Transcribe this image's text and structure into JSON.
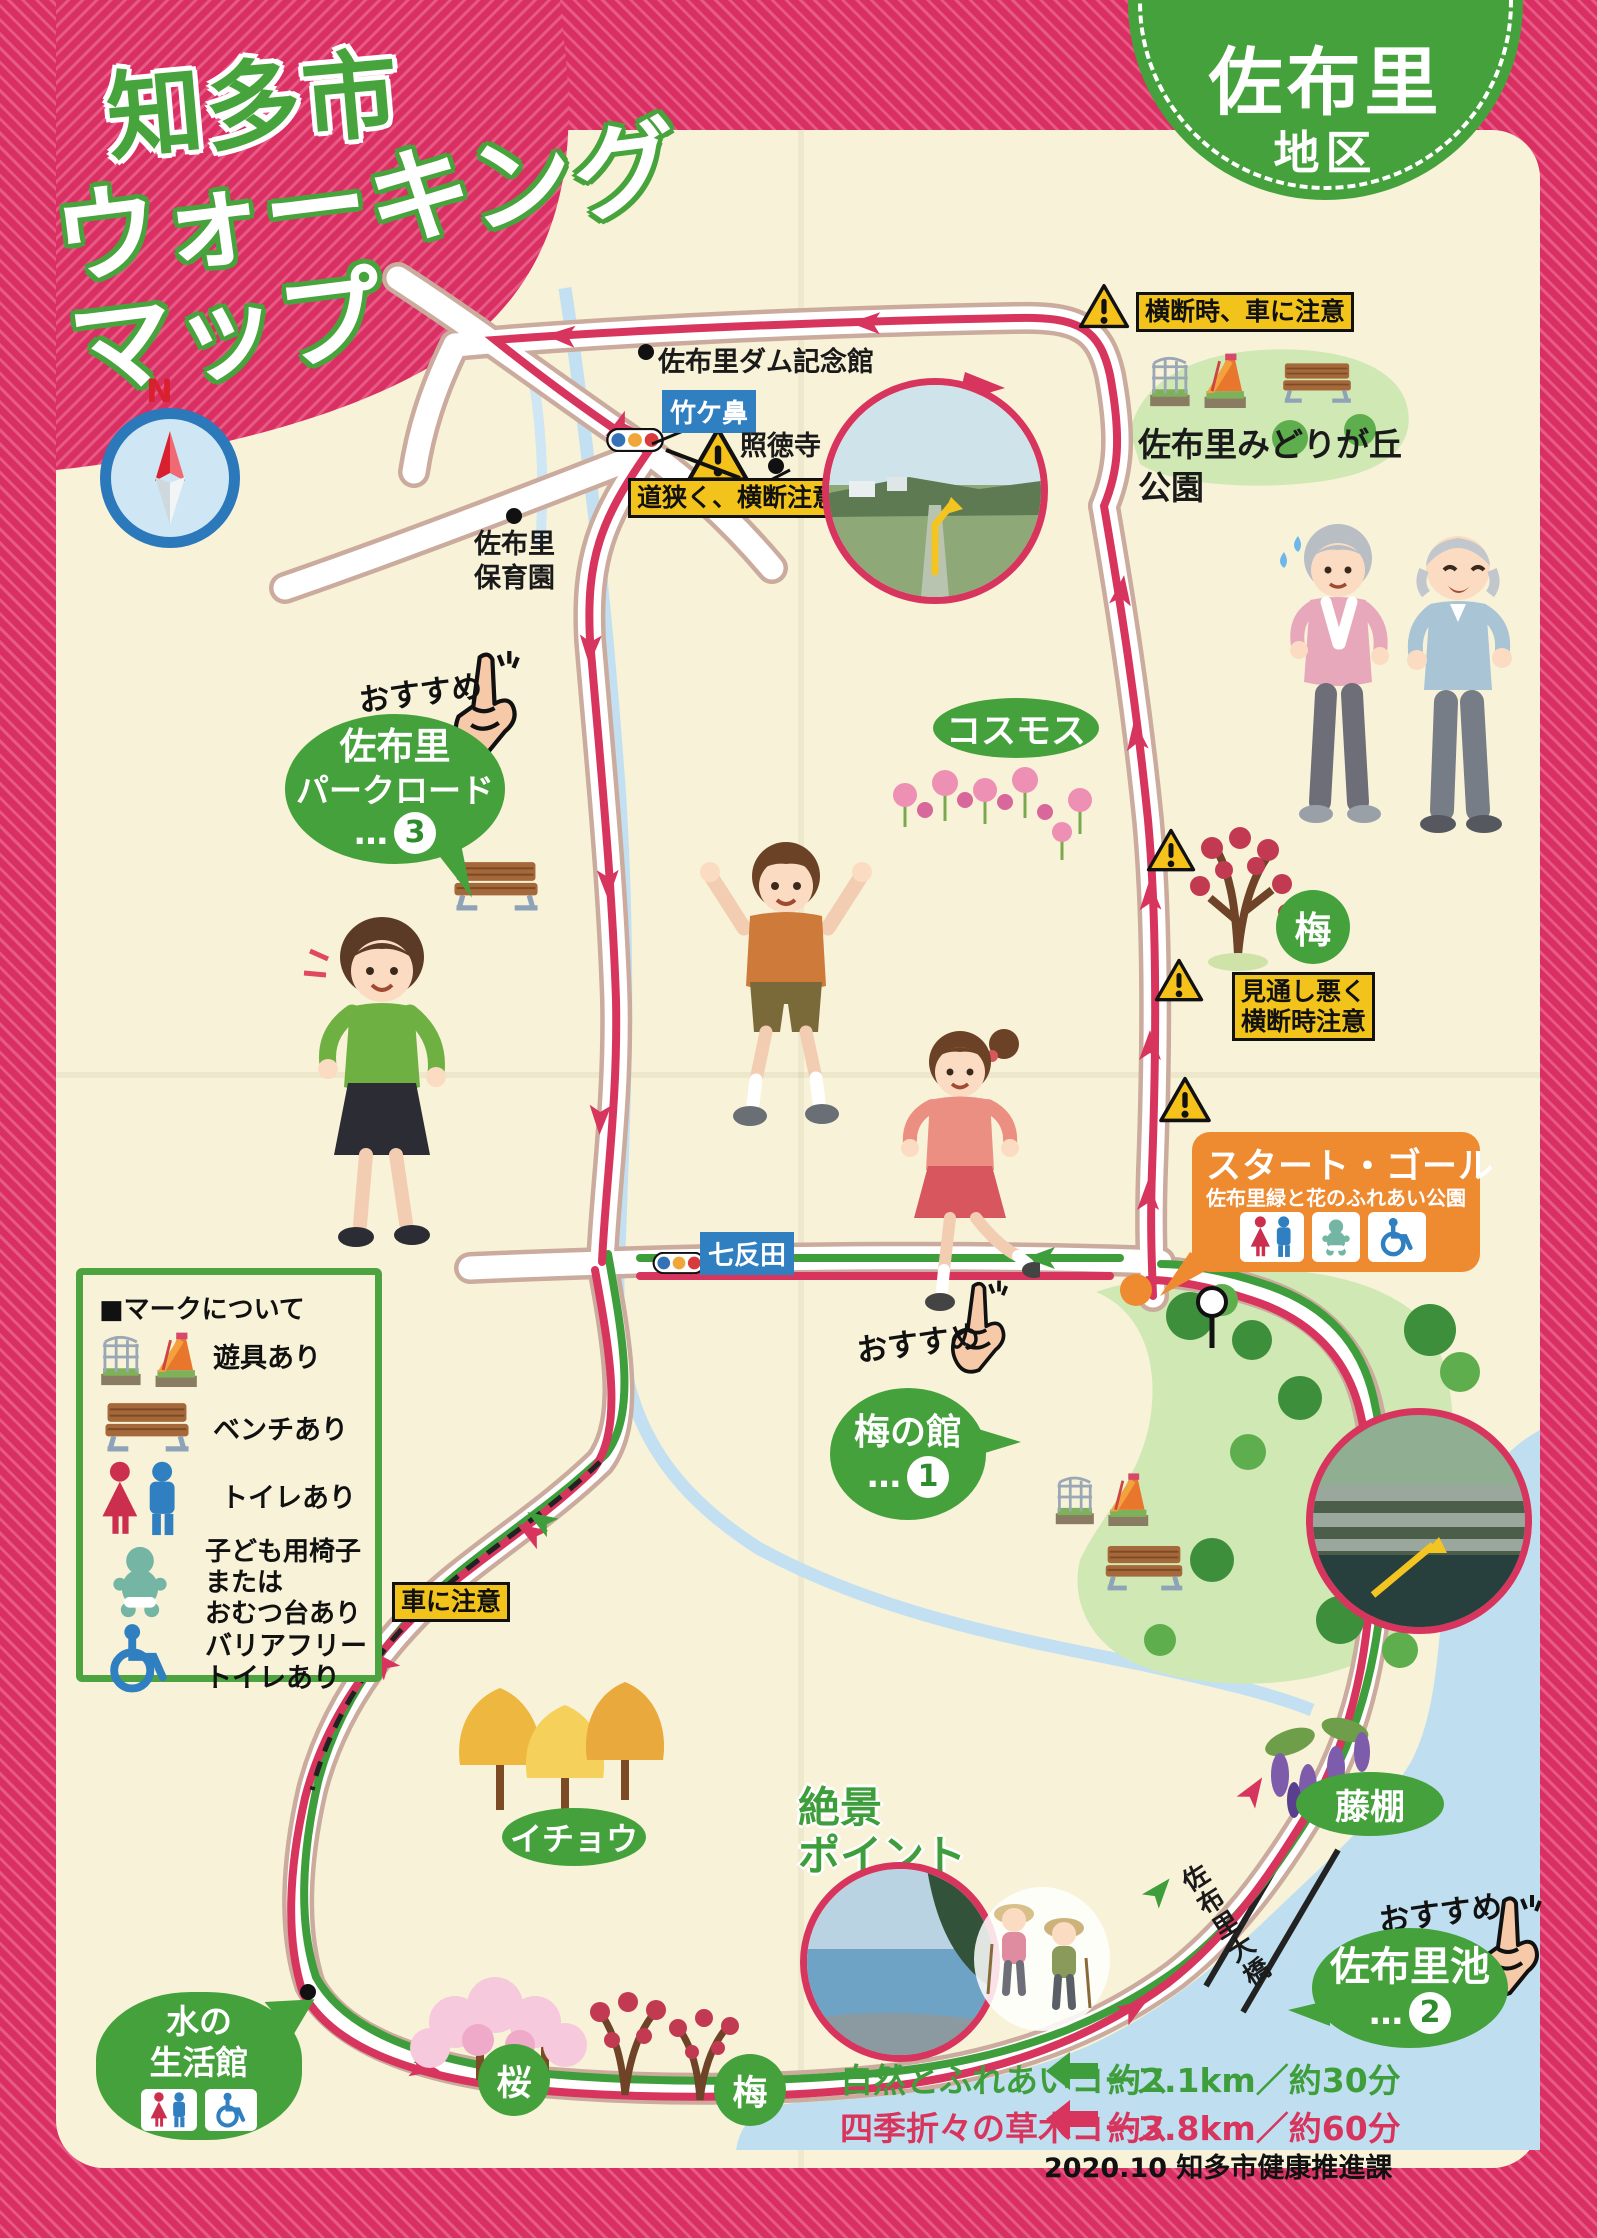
{
  "title": {
    "line1": "知多市",
    "line2": "ウォーキング",
    "line3": "マップ"
  },
  "badge": {
    "name": "佐布里",
    "sub": "地区"
  },
  "compass": {
    "label": "N"
  },
  "recommend": {
    "label": "おすすめ"
  },
  "places": {
    "dam_hall": "佐布里ダム記念館",
    "takegahana": "竹ケ鼻",
    "shotokuji": "照徳寺",
    "nursery": {
      "lines": [
        "佐布里",
        "保育園"
      ]
    },
    "midorigaoka": {
      "lines": [
        "佐布里みどりが丘",
        "公園"
      ]
    },
    "cosmos": "コスモス",
    "ume_east": "梅",
    "shichitanda": "七反田",
    "icho": "イチョウ",
    "zekkei": {
      "lines": [
        "絶景",
        "ポイント"
      ]
    },
    "fujidana": "藤棚",
    "sori_ohashi": "佐布里大橋",
    "sakura": "桜",
    "ume_south": "梅"
  },
  "bubbles": {
    "parkroad": {
      "line1": "佐布里",
      "line2": "パークロード",
      "dots": "…",
      "num": "3"
    },
    "umenoyakata": {
      "line1": "梅の館",
      "dots": "…",
      "num": "1"
    },
    "soriike": {
      "line1": "佐布里池",
      "dots": "…",
      "num": "2"
    },
    "mizuno": {
      "line1": "水の",
      "line2": "生活館"
    }
  },
  "warnings": {
    "crossing_car": "横断時、車に注意",
    "narrow_road": "道狭く、横断注意",
    "visibility": {
      "line1": "見通し悪く",
      "line2": "横断時注意"
    },
    "car": "車に注意"
  },
  "start_goal": {
    "title": "スタート・ゴール",
    "subtitle": "佐布里緑と花のふれあい公園"
  },
  "legend": {
    "header": "■マークについて",
    "items": [
      {
        "icon": "playground-icon",
        "label": "遊具あり"
      },
      {
        "icon": "bench-icon",
        "label": "ベンチあり"
      },
      {
        "icon": "toilet-icon",
        "label": "トイレあり"
      },
      {
        "icon": "baby-chair-icon",
        "lines": [
          "子ども用椅子",
          "または",
          "おむつ台あり"
        ]
      },
      {
        "icon": "accessible-toilet-icon",
        "lines": [
          "バリアフリー",
          "トイレあり"
        ]
      }
    ]
  },
  "courses": [
    {
      "name": "自然とふれあいコース",
      "detail": "約2.1km／約30分",
      "color": "#3f9e3c"
    },
    {
      "name": "四季折々の草木コース",
      "detail": "約3.8km／約60分",
      "color": "#d8355e"
    }
  ],
  "footer": {
    "credit": "2020.10  知多市健康推進課"
  }
}
